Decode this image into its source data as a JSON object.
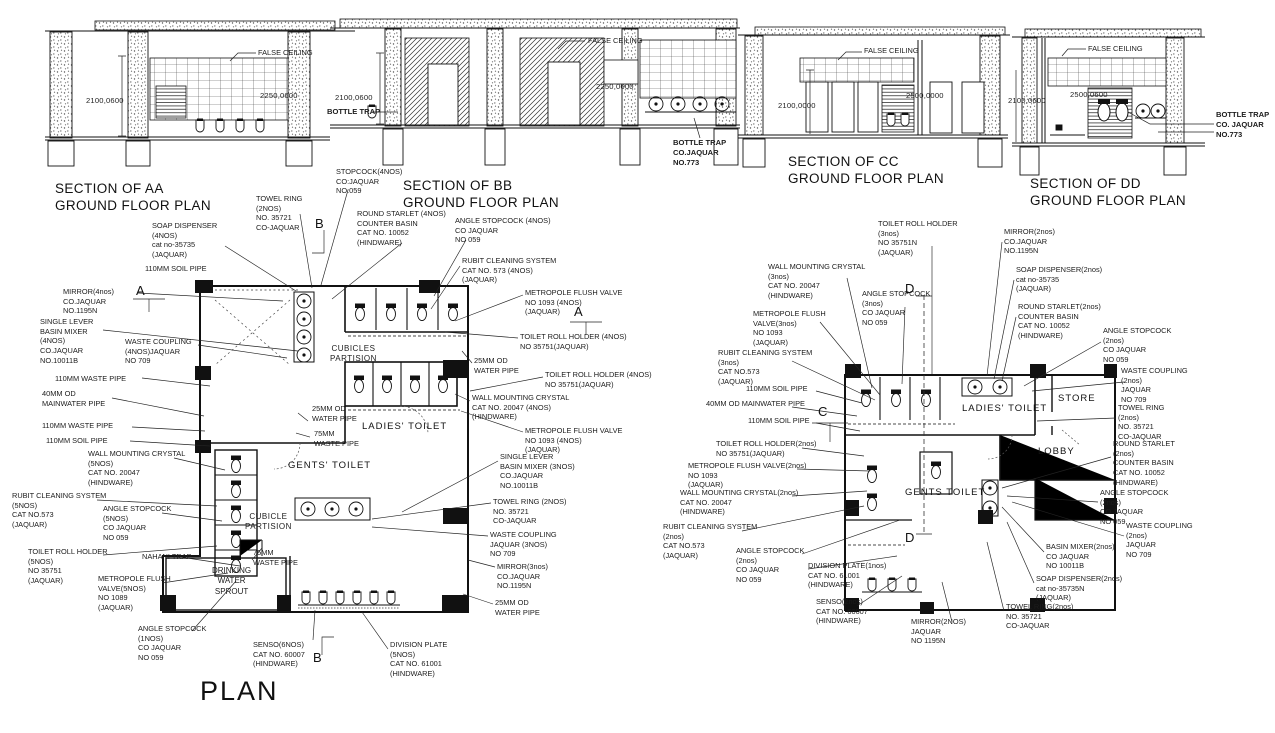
{
  "colors": {
    "ink": "#1c1c1c",
    "background": "#ffffff"
  },
  "titles": {
    "plan": "PLAN"
  },
  "sections": {
    "aa": {
      "title": "SECTION OF  AA\nGROUND FLOOR PLAN",
      "false_ceiling": "FALSE CEILING",
      "dim_height": "2100,0600",
      "dim_ceiling": "2250,0600"
    },
    "bb": {
      "title": "SECTION OF  BB\nGROUND FLOOR PLAN",
      "false_ceiling": "FALSE CEILING",
      "dim_height": "2100,0600",
      "dim_ceiling": "2250,0600",
      "bottle_trap": "BOTTLE TRAP",
      "bottle_trap_note": "BOTTLE TRAP\nCO.JAQUAR\nNO.773"
    },
    "cc": {
      "title": "SECTION OF  CC\nGROUND FLOOR PLAN",
      "false_ceiling": "FALSE CEILING",
      "dim_height": "2100,0000",
      "dim_ceiling": "2500,0000"
    },
    "dd": {
      "title": "SECTION OF  DD\nGROUND FLOOR PLAN",
      "false_ceiling": "FALSE CEILING",
      "dim_height": "2100,0600",
      "dim_ceiling": "2500,0600",
      "bottle_trap_note": "BOTTLE TRAP\nCO. JAQUAR\nNO.773"
    }
  },
  "plan_left": {
    "rooms": {
      "cubicles_partision": "CUBICLES\nPARTISION",
      "cubicle_partision": "CUBICLE\nPARTISION",
      "ladies_toilet": "LADIES' TOILET",
      "gents_toilet": "GENTS' TOILET",
      "drinking": "DRINKING\nWATER\nSPROUT"
    },
    "markers": {
      "a": "A",
      "b": "B"
    },
    "labels": {
      "stopcock4": "STOPCOCK(4NOS)\nCO:JAQUAR\nNO:059",
      "towel_ring_top": "TOWEL RING\n(2NOS)\nNO. 35721\nCO-JAQUAR",
      "soap_dispenser4": "SOAP DISPENSER\n(4NOS)\ncat no-35735\n(JAQUAR)",
      "soil110_top": "110MM SOIL PIPE",
      "round_starlet4": "ROUND STARLET (4NOS)\nCOUNTER BASIN\nCAT NO. 10052\n(HINDWARE)",
      "angle_stopcock4": "ANGLE STOPCOCK (4NOS)\nCO  JAQUAR\nNO  059",
      "mirror4": "MIRROR(4nos)\nCO.JAQUAR\nNO.1195N",
      "single_lever4": "SINGLE LEVER\nBASIN MIXER\n(4NOS)\nCO.JAQUAR\nNO.10011B",
      "waste_coupling4": "WASTE COUPLING\n(4NOS)JAQUAR\nNO 709",
      "waste110_a": "110MM WASTE PIPE",
      "mainwater40": "40MM OD\nMAINWATER PIPE",
      "waste110_b": "110MM WASTE PIPE",
      "soil110_b": "110MM SOIL PIPE",
      "wall_crystal5": "WALL MOUNTING CRYSTAL\n(5NOS)\nCAT NO. 20047\n(HINDWARE)",
      "rubit5": "RUBIT CLEANING SYSTEM\n(5NOS)\nCAT NO.573\n(JAQUAR)",
      "angle_stopcock5": "ANGLE STOPCOCK\n(5NOS)\nCO  JAQUAR\nNO  059",
      "toilet_roll5": "TOILET ROLL HOLDER\n(5NOS)\nNO 35751\n(JAQUAR)",
      "nahani_trap": "NAHANI TRAP",
      "metropole5": "METROPOLE FLUSH\nVALVE(5NOS)\nNO 1089\n(JAQUAR)",
      "angle_stopcock1": "ANGLE STOPCOCK\n(1NOS)\nCO  JAQUAR\nNO  059",
      "waste75_low": "75MM\nWASTE PIPE",
      "water25_mid": "25MM OD\nWATER PIPE",
      "waste75_mid": "75MM\nWASTE PIPE",
      "senso6": "SENSO(6NOS)\nCAT NO. 60007\n(HINDWARE)",
      "division5": "DIVISION PLATE\n(5NOS)\nCAT NO. 61001\n(HINDWARE)",
      "rubit4": "RUBIT CLEANING SYSTEM\nCAT NO. 573     (4NOS)\n(JAQUAR)",
      "metropole4a": "METROPOLE FLUSH VALVE\nNO 1093    (4NOS)\n(JAQUAR)",
      "toilet_roll4a": "TOILET ROLL HOLDER  (4NOS)\nNO 35751(JAQUAR)",
      "water25_r1": "25MM OD\nWATER PIPE",
      "toilet_roll4b": "TOILET ROLL HOLDER  (4NOS)\nNO 35751(JAQUAR)",
      "wall_crystal4": "WALL MOUNTING CRYSTAL\nCAT NO. 20047     (4NOS)\n(HINDWARE)",
      "metropole4b": "METROPOLE FLUSH VALVE\nNO 1093    (4NOS)\n(JAQUAR)",
      "single_lever3": "SINGLE LEVER\nBASIN MIXER (3NOS)\nCO.JAQUAR\nNO.10011B",
      "towel_ring_r": "TOWEL RING (2NOS)\nNO. 35721\nCO-JAQUAR",
      "waste_coupling3": "WASTE COUPLING\nJAQUAR (3NOS)\nNO 709",
      "mirror3": "MIRROR(3nos)\nCO.JAQUAR\nNO.1195N",
      "water25_r2": "25MM OD\nWATER PIPE"
    }
  },
  "plan_right": {
    "rooms": {
      "ladies_toilet": "LADIES' TOILET",
      "store": "STORE",
      "lobby": "LOBBY",
      "gents_toilet": "GENTS TOILET"
    },
    "markers": {
      "c": "C",
      "d": "D"
    },
    "labels": {
      "toilet_roll3": "TOILET ROLL HOLDER\n(3nos)\nNO 35751N\n(JAQUAR)",
      "mirror2_top": "MIRROR(2nos)\nCO.JAQUAR\nNO.1195N",
      "wall_crystal3": "WALL MOUNTING CRYSTAL\n(3nos)\nCAT NO. 20047\n(HINDWARE)",
      "soap2_top": "SOAP DISPENSER(2nos)\ncat no-35735\n(JAQUAR)",
      "angle_stopcock3": "ANGLE STOPCOCK\n(3nos)\nCO  JAQUAR\nNO 059",
      "round_starlet2_top": "ROUND STARLET(2nos)\nCOUNTER BASIN\nCAT NO. 10052\n(HINDWARE)",
      "metropole3": "METROPOLE FLUSH\nVALVE(3nos)\nNO 1093\n(JAQUAR)",
      "angle_stopcock2_a": "ANGLE STOPCOCK\n(2nos)\nCO  JAQUAR\nNO  059",
      "rubit3": "RUBIT CLEANING SYSTEM\n(3nos)\nCAT NO.573\n(JAQUAR)",
      "waste_coupling2_a": "WASTE COUPLING\n(2nos)\nJAQUAR\nNO 709",
      "soil110_a": "110MM SOIL PIPE",
      "mainwater40": "40MM OD MAINWATER PIPE",
      "towel_ring2_r": "TOWEL RING\n(2nos)\nNO. 35721\nCO-JAQUAR",
      "soil110_b": "110MM SOIL PIPE",
      "toilet_roll2": "TOILET ROLL HOLDER(2nos)\nNO 35751(JAQUAR)",
      "round_starlet2_r": "ROUND STARLET\n(2nos)\nCOUNTER BASIN\nCAT NO. 10052\n(HINDWARE)",
      "metropole2": "METROPOLE FLUSH VALVE(2nos)\nNO 1093\n(JAQUAR)",
      "wall_crystal2": "WALL MOUNTING CRYSTAL(2nos)\nCAT NO. 20047\n(HINDWARE)",
      "angle_stopcock2_b": "ANGLE STOPCOCK\n(2nos)\nCO  JAQUAR\nNO  059",
      "rubit2": "RUBIT CLEANING SYSTEM\n(2nos)\nCAT NO.573\n(JAQUAR)",
      "waste_coupling2_b": "WASTE COUPLING\n(2nos)\nJAQUAR\nNO 709",
      "angle_stopcock2_c": "ANGLE STOPCOCK\n(2nos)\nCO  JAQUAR\nNO 059",
      "basin_mixer2": "BASIN MIXER(2nos)\nCO  JAQUAR\nNO  10011B",
      "division1": "DIVISION PLATE(1nos)\nCAT NO. 61001\n(HINDWARE)",
      "soap2_bot": "SOAP DISPENSER(2nos)\ncat no-35735N\n(JAQUAR)",
      "senso2": "SENSO(2nos)\nCAT NO. 60007\n(HINDWARE)",
      "towel_ring2_bot": "TOWEL RING(2nos)\nNO. 35721\nCO-JAQUAR",
      "mirror2_bot": "MIRROR(2NOS)\nJAQUAR\nNO 1195N"
    }
  }
}
